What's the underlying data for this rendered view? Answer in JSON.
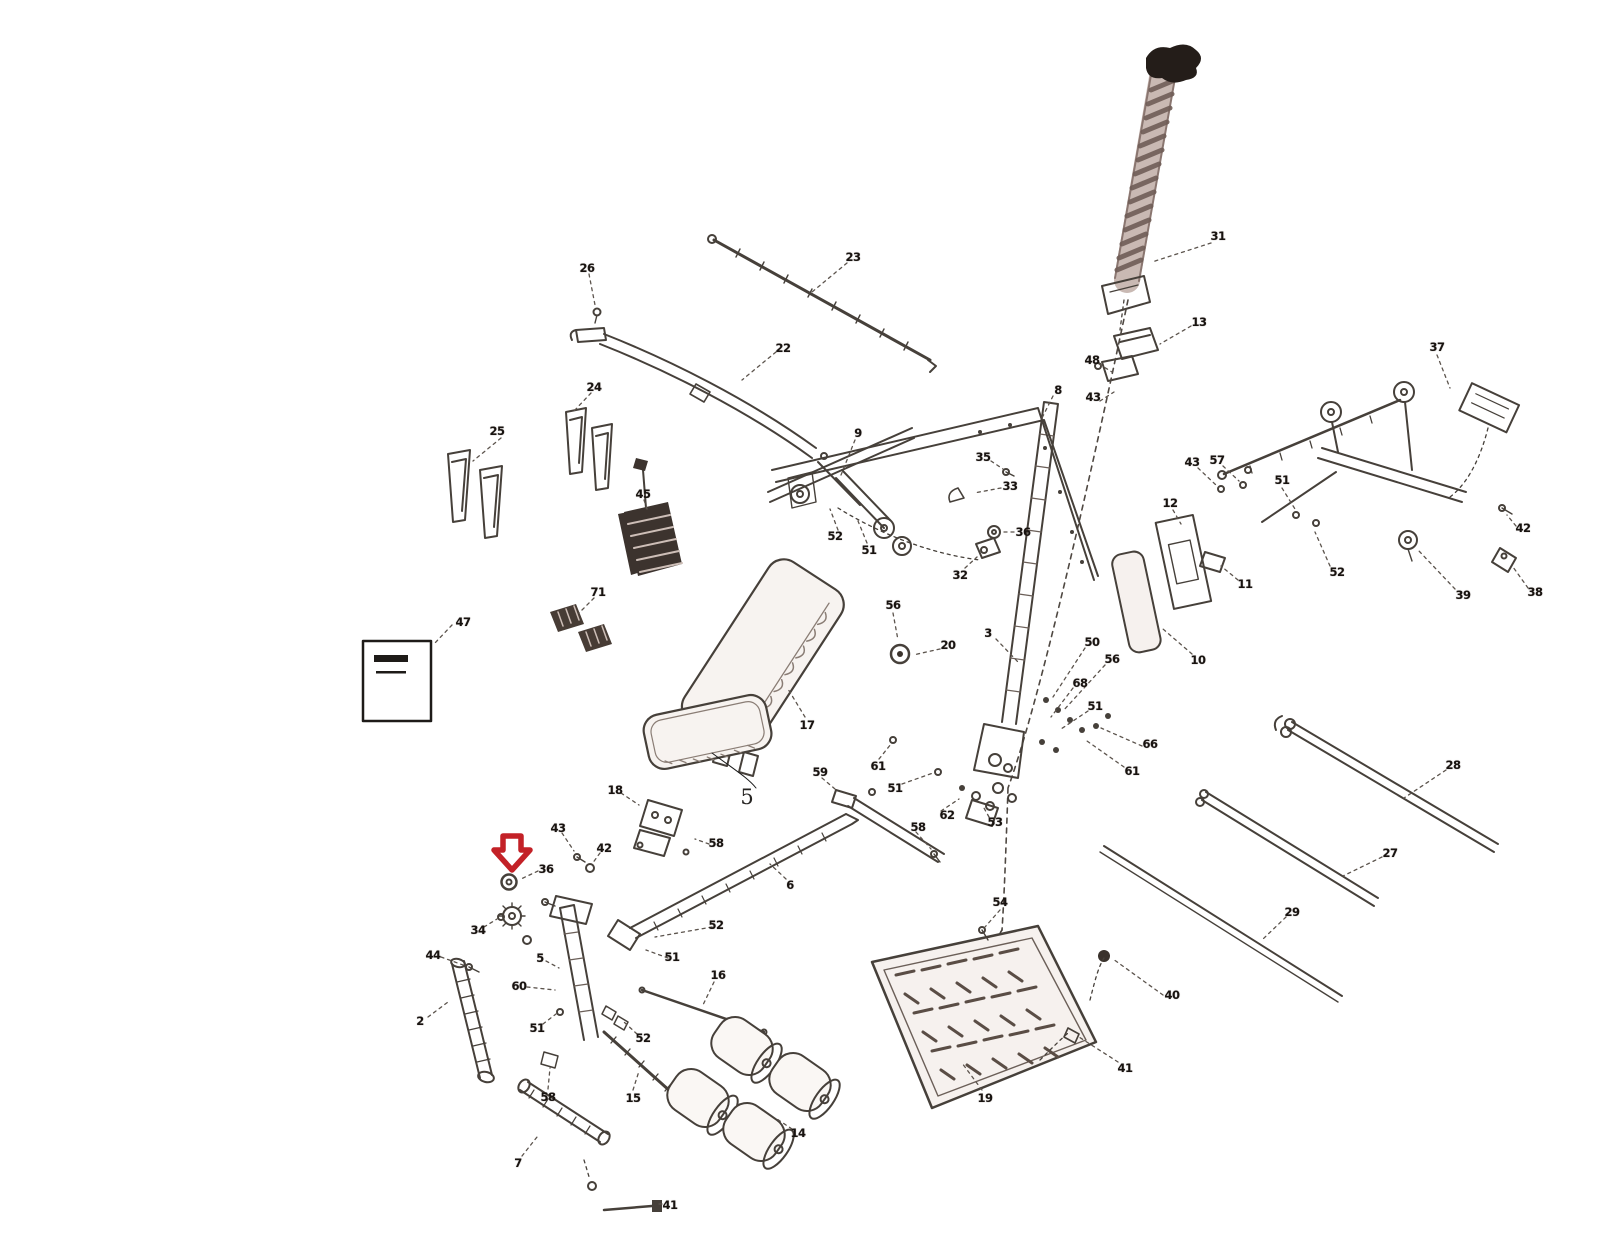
{
  "figure": {
    "type": "exploded-parts-diagram",
    "subject": "Exercise bench / home gym exploded assembly view with numbered parts",
    "background_color": "#ffffff",
    "line_color": "#46403a"
  },
  "annotations": {
    "highlight_arrow": {
      "shape": "down-arrow-outline",
      "color": "#c32127",
      "x": 512,
      "y": 852
    },
    "handwritten_label": {
      "text": "5",
      "x": 747,
      "y": 797
    }
  },
  "parts": [
    {
      "id": "31",
      "x": 1218,
      "y": 236
    },
    {
      "id": "13",
      "x": 1199,
      "y": 322
    },
    {
      "id": "48",
      "x": 1092,
      "y": 360
    },
    {
      "id": "43",
      "x": 1093,
      "y": 397
    },
    {
      "id": "8",
      "x": 1058,
      "y": 390
    },
    {
      "id": "23",
      "x": 853,
      "y": 257
    },
    {
      "id": "22",
      "x": 783,
      "y": 348
    },
    {
      "id": "26",
      "x": 587,
      "y": 268
    },
    {
      "id": "24",
      "x": 594,
      "y": 387
    },
    {
      "id": "25",
      "x": 497,
      "y": 431
    },
    {
      "id": "45",
      "x": 643,
      "y": 494
    },
    {
      "id": "71",
      "x": 598,
      "y": 592
    },
    {
      "id": "47",
      "x": 463,
      "y": 622
    },
    {
      "id": "9",
      "x": 858,
      "y": 433
    },
    {
      "id": "35",
      "x": 983,
      "y": 457
    },
    {
      "id": "33",
      "x": 1010,
      "y": 486
    },
    {
      "id": "36",
      "x": 1023,
      "y": 532
    },
    {
      "id": "32",
      "x": 960,
      "y": 575
    },
    {
      "id": "52",
      "x": 835,
      "y": 536
    },
    {
      "id": "51",
      "x": 869,
      "y": 550
    },
    {
      "id": "3",
      "x": 988,
      "y": 633
    },
    {
      "id": "20",
      "x": 948,
      "y": 645
    },
    {
      "id": "56",
      "x": 893,
      "y": 605
    },
    {
      "id": "50",
      "x": 1092,
      "y": 642
    },
    {
      "id": "56",
      "x": 1112,
      "y": 659
    },
    {
      "id": "68",
      "x": 1080,
      "y": 683
    },
    {
      "id": "51",
      "x": 1095,
      "y": 706
    },
    {
      "id": "66",
      "x": 1150,
      "y": 744
    },
    {
      "id": "61",
      "x": 1132,
      "y": 771
    },
    {
      "id": "10",
      "x": 1198,
      "y": 660
    },
    {
      "id": "12",
      "x": 1170,
      "y": 503
    },
    {
      "id": "43",
      "x": 1192,
      "y": 462
    },
    {
      "id": "57",
      "x": 1217,
      "y": 460
    },
    {
      "id": "51",
      "x": 1282,
      "y": 480
    },
    {
      "id": "11",
      "x": 1245,
      "y": 584
    },
    {
      "id": "52",
      "x": 1337,
      "y": 572
    },
    {
      "id": "37",
      "x": 1437,
      "y": 347
    },
    {
      "id": "42",
      "x": 1523,
      "y": 528
    },
    {
      "id": "39",
      "x": 1463,
      "y": 595
    },
    {
      "id": "38",
      "x": 1535,
      "y": 592
    },
    {
      "id": "28",
      "x": 1453,
      "y": 765
    },
    {
      "id": "27",
      "x": 1390,
      "y": 853
    },
    {
      "id": "29",
      "x": 1292,
      "y": 912
    },
    {
      "id": "17",
      "x": 807,
      "y": 725
    },
    {
      "id": "59",
      "x": 820,
      "y": 772
    },
    {
      "id": "61",
      "x": 878,
      "y": 766
    },
    {
      "id": "51",
      "x": 895,
      "y": 788
    },
    {
      "id": "62",
      "x": 947,
      "y": 815
    },
    {
      "id": "53",
      "x": 995,
      "y": 822
    },
    {
      "id": "58",
      "x": 918,
      "y": 827
    },
    {
      "id": "18",
      "x": 615,
      "y": 790
    },
    {
      "id": "58",
      "x": 716,
      "y": 843
    },
    {
      "id": "43",
      "x": 558,
      "y": 828
    },
    {
      "id": "42",
      "x": 604,
      "y": 848
    },
    {
      "id": "36",
      "x": 546,
      "y": 869
    },
    {
      "id": "34",
      "x": 478,
      "y": 930
    },
    {
      "id": "44",
      "x": 433,
      "y": 955
    },
    {
      "id": "2",
      "x": 420,
      "y": 1021
    },
    {
      "id": "5",
      "x": 540,
      "y": 958
    },
    {
      "id": "60",
      "x": 519,
      "y": 986
    },
    {
      "id": "51",
      "x": 537,
      "y": 1028
    },
    {
      "id": "52",
      "x": 643,
      "y": 1038
    },
    {
      "id": "52",
      "x": 716,
      "y": 925
    },
    {
      "id": "51",
      "x": 672,
      "y": 957
    },
    {
      "id": "6",
      "x": 790,
      "y": 885
    },
    {
      "id": "16",
      "x": 718,
      "y": 975
    },
    {
      "id": "58",
      "x": 548,
      "y": 1097
    },
    {
      "id": "15",
      "x": 633,
      "y": 1098
    },
    {
      "id": "7",
      "x": 518,
      "y": 1163
    },
    {
      "id": "41",
      "x": 670,
      "y": 1205
    },
    {
      "id": "14",
      "x": 798,
      "y": 1133
    },
    {
      "id": "19",
      "x": 985,
      "y": 1098
    },
    {
      "id": "54",
      "x": 1000,
      "y": 902
    },
    {
      "id": "40",
      "x": 1172,
      "y": 995
    },
    {
      "id": "41",
      "x": 1125,
      "y": 1068
    }
  ]
}
